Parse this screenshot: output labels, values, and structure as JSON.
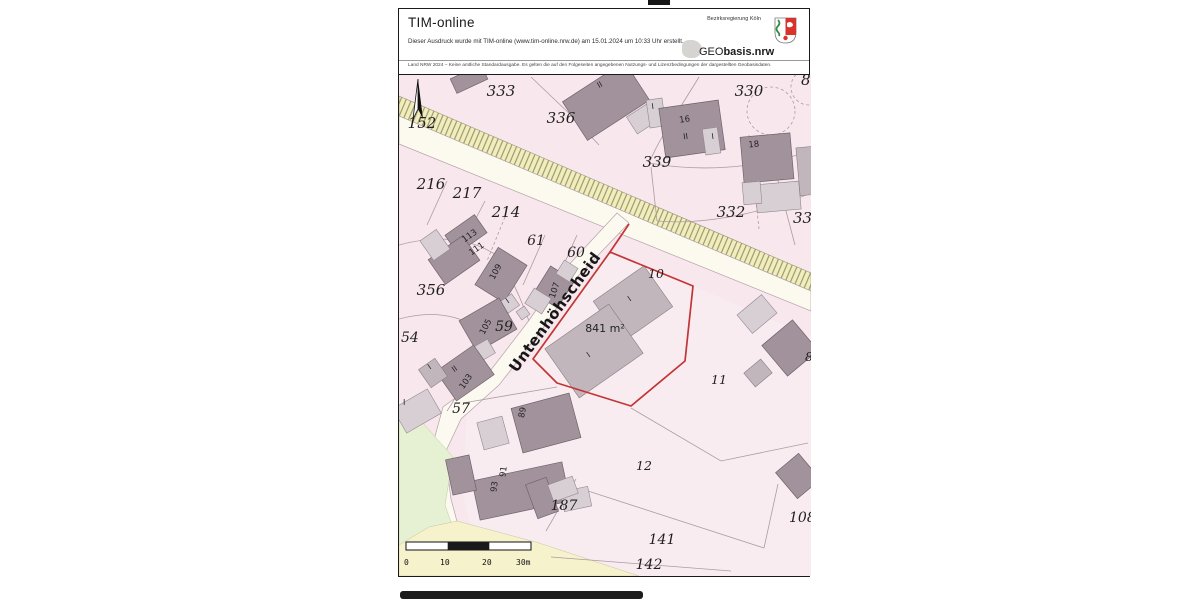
{
  "header": {
    "app_title": "TIM-online",
    "print_note": "Dieser Ausdruck wurde mit TIM-online (www.tim-online.nrw.de) am 15.01.2024 um 10:33 Uhr erstellt.",
    "disclaimer": "Land NRW 2024 – Keine amtliche Standardausgabe. Es gelten die auf den Folgeseiten angegebenen Nutzungs- und Lizenzbedingungen der dargestellten Geobasisdaten.",
    "agency": "Bezirksregierung Köln",
    "logo_prefix": "GEO",
    "logo_suffix": "basis.nrw"
  },
  "map": {
    "street_name": "Untenhöhscheid",
    "highlighted_parcel": {
      "number": "10",
      "area_label": "841 m²",
      "outline_color": "#c23535"
    },
    "parcel_labels": [
      {
        "text": "333"
      },
      {
        "text": "336"
      },
      {
        "text": "330"
      },
      {
        "text": "86"
      },
      {
        "text": "152"
      },
      {
        "text": "339"
      },
      {
        "text": "216"
      },
      {
        "text": "217"
      },
      {
        "text": "214"
      },
      {
        "text": "61"
      },
      {
        "text": "60"
      },
      {
        "text": "332"
      },
      {
        "text": "33"
      },
      {
        "text": "10"
      },
      {
        "text": "356"
      },
      {
        "text": "54"
      },
      {
        "text": "59"
      },
      {
        "text": "11"
      },
      {
        "text": "57"
      },
      {
        "text": "12"
      },
      {
        "text": "187"
      },
      {
        "text": "141"
      },
      {
        "text": "142"
      },
      {
        "text": "108"
      },
      {
        "text": "8"
      }
    ],
    "house_numbers": [
      {
        "text": "113"
      },
      {
        "text": "111"
      },
      {
        "text": "109"
      },
      {
        "text": "107"
      },
      {
        "text": "105"
      },
      {
        "text": "103"
      },
      {
        "text": "89"
      },
      {
        "text": "93"
      },
      {
        "text": "91"
      },
      {
        "text": "16"
      },
      {
        "text": "18"
      }
    ],
    "floor_labels": [
      {
        "text": "II"
      },
      {
        "text": "I"
      },
      {
        "text": "II"
      },
      {
        "text": "I"
      },
      {
        "text": "I"
      },
      {
        "text": "I"
      },
      {
        "text": "II"
      },
      {
        "text": "I"
      },
      {
        "text": "I"
      },
      {
        "text": "I"
      }
    ],
    "scale_bar": {
      "ticks": [
        {
          "label": "0"
        },
        {
          "label": "10"
        },
        {
          "label": "20"
        },
        {
          "label": "30m"
        }
      ]
    },
    "colors": {
      "parcel_fill": "#f8e7ed",
      "road_hatch_fill": "#f2eebb",
      "roadway_fill": "#fcfaef",
      "vegetation_fill": "#e6f0d2",
      "building_dark": "#a2929c",
      "building_light": "#d8cfd5",
      "highlight_outline": "#c23535"
    }
  }
}
